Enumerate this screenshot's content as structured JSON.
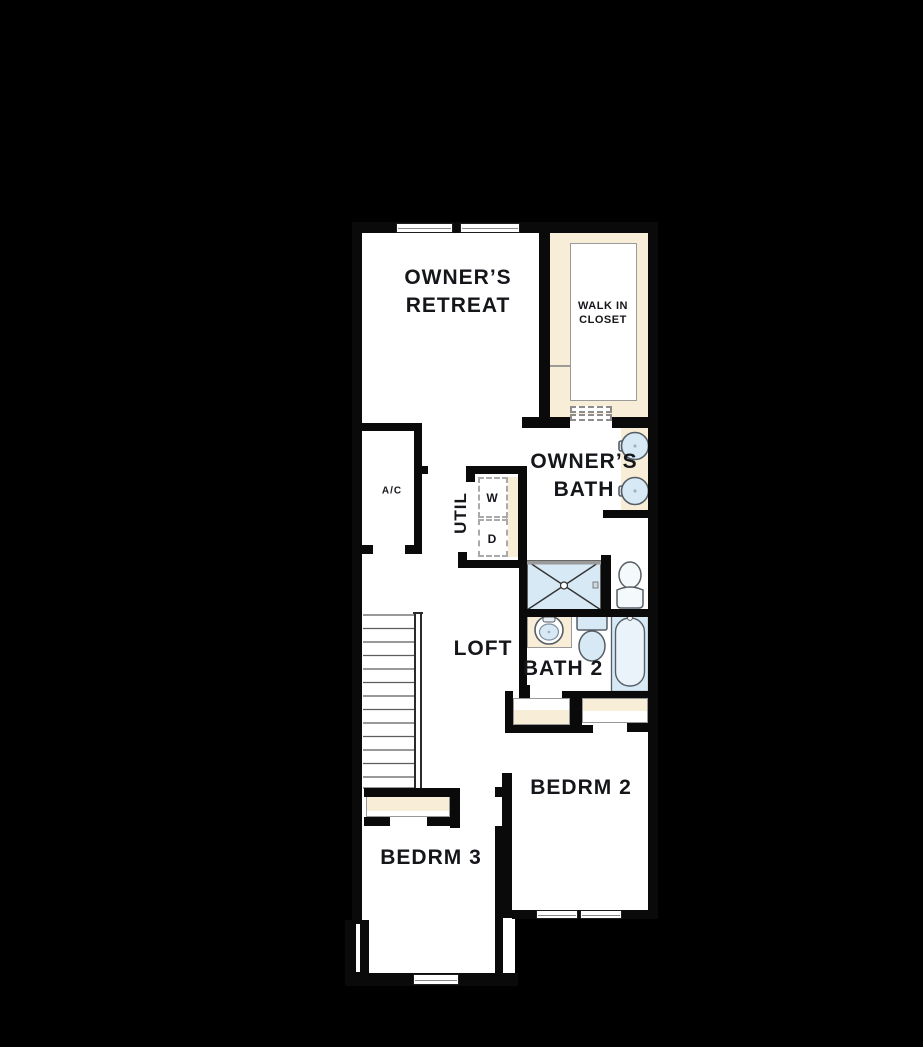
{
  "title": "Second Floor Plan",
  "colors": {
    "bg": "#000000",
    "wall": "#0a0a0a",
    "floor": "#ffffff",
    "tan": "#f8edd6",
    "fixture": "#d8e9f6",
    "fixture-light": "#eaf3fa",
    "outline": "#555e66",
    "label": "#14161a",
    "winline": "#8a8a8a"
  },
  "rooms": {
    "owners_retreat": {
      "line1": "OWNER’S",
      "line2": "RETREAT"
    },
    "walk_in_closet": {
      "line1": "WALK IN",
      "line2": "CLOSET"
    },
    "owners_bath": {
      "line1": "OWNER’S",
      "line2": "BATH"
    },
    "ac_closet": {
      "label": "A/C"
    },
    "utility": {
      "label": "UTIL",
      "washer": "W",
      "dryer": "D"
    },
    "loft": {
      "label": "LOFT"
    },
    "bath2": {
      "label": "BATH 2"
    },
    "bedroom2": {
      "label": "BEDRM 2"
    },
    "bedroom3": {
      "label": "BEDRM 3"
    }
  },
  "fixtures": [
    "double-vanity-sinks",
    "walk-in-shower",
    "water-closet-toilet",
    "bath2-sink",
    "bath2-toilet",
    "bathtub",
    "stacked-washer-dryer",
    "staircase",
    "windows"
  ]
}
